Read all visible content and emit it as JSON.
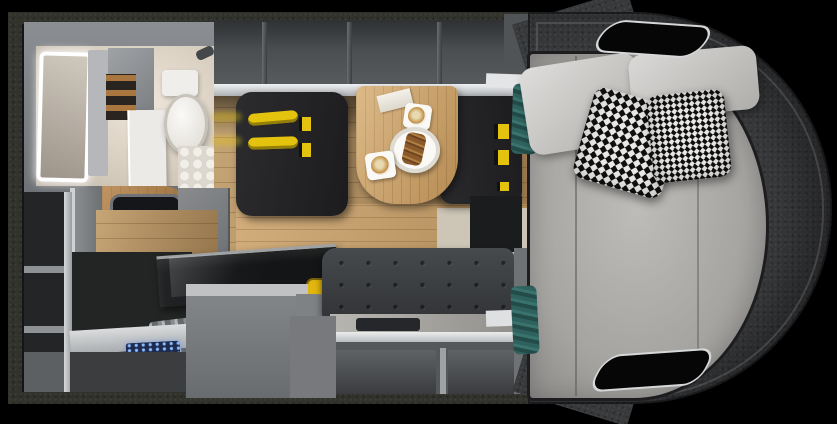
{
  "meta": {
    "title": "Camper van interior floor plan - top-down 3D render",
    "view": "top view cutaway"
  },
  "palette": {
    "background": "#000000",
    "wall": "#30322b",
    "interior_dark": "#141517",
    "locker_gray": "#47494c",
    "rail_light": "#dfe1e3",
    "bathroom_frame": "#7d8084",
    "white_fixture": "#f0eeea",
    "seat_black": "#232327",
    "seatbelt_yellow": "#e3c30e",
    "accent_yellow": "#e2b70f",
    "sofa_gray": "#3c3e41",
    "cabinet_gray": "#74777a",
    "panel_blue": "#1c2b4e",
    "shell_dark": "#38393b",
    "mattress_gray": "#aaa9a6",
    "pillow_light": "#cfcecb",
    "towel_teal": "#2f625e",
    "plate_white": "#faf9f6",
    "coffee_brown": "#c08a3e",
    "pastry_brown": "#7d5226",
    "wood_mid": "#a9763f"
  },
  "regions": {
    "vehicle": {
      "label": "camper van floor plan, top view"
    },
    "bathroom": {
      "label": "bathroom with LED mirror, toilet and shower"
    },
    "overhead_lockers": {
      "label": "open overhead lockers (4 compartments)",
      "compartments": 4
    },
    "dinette": {
      "label": "dinette with two travel seats and wood table",
      "left_seat": {
        "label": "travel bench seat with two yellow seat belts",
        "seatbelts": 2
      },
      "right_seat": {
        "label": "travel bench seat with yellow belt buckles"
      },
      "table": {
        "label": "wood dining table",
        "items": [
          "folded paper",
          "cappuccino on square saucer",
          "plate with pastry",
          "cappuccino on square saucer"
        ]
      }
    },
    "tv_unit": {
      "label": "wardrobe column with flat-screen TV"
    },
    "shelf_column": {
      "label": "open shelf column (3 shelves)",
      "shelves": 3
    },
    "kitchen": {
      "label": "kitchen block with covered hob, yellow container"
    },
    "entry_step": {
      "label": "entry area with step rails and blue-lit control panel"
    },
    "sofa": {
      "label": "tufted lounge sofa with storage below",
      "storage_compartments": 3
    },
    "bed": {
      "label": "rear lounge bed inside rounded body shell",
      "pillows": [
        {
          "type": "plain light gray"
        },
        {
          "type": "plain light gray"
        },
        {
          "type": "houndstooth"
        },
        {
          "type": "houndstooth"
        }
      ],
      "towels": 2,
      "shell_openings": 2
    }
  }
}
